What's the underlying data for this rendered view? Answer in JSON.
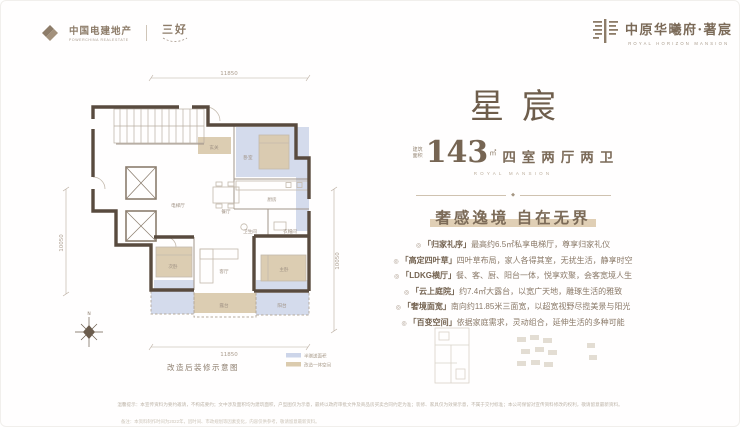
{
  "header": {
    "left": {
      "brand": "中国电建地产",
      "brand_en": "POWERCHINA REALESTATE",
      "sub_brand": "三好"
    },
    "right": {
      "brand": "中原华曦府·著宸",
      "brand_en": "ROYAL HORIZON MANSION"
    }
  },
  "panel": {
    "title": "星宸",
    "area_prefix_top": "建筑",
    "area_prefix_bottom": "面积",
    "area_value": "143",
    "area_unit": "㎡",
    "layout_text": "四室两厅两卫",
    "layout_en": "ROYAL MANSION",
    "divider_glyph": "◆",
    "slogan": "奢感逸境 自在无界",
    "bullet": "◎",
    "features": [
      {
        "tag": "「归家礼序」",
        "desc": "最高约6.5㎡私享电梯厅，尊享归家礼仪"
      },
      {
        "tag": "「高定四叶草」",
        "desc": "四叶草布局，家人各得其室，无扰生活，静享时空"
      },
      {
        "tag": "「LDKG横厅」",
        "desc": "餐、客、厨、阳台一体，悦享欢聚，会客宽境人生"
      },
      {
        "tag": "「云上庭院」",
        "desc": "约7.4㎡大露台，以宽广天地，雕琢生活的雅致"
      },
      {
        "tag": "「奢境面宽」",
        "desc": "南向约11.85米三面宽，以超宽视野尽揽美景与阳光"
      },
      {
        "tag": "「百变空间」",
        "desc": "依据家庭需求，灵动组合，延伸生活的多种可能"
      }
    ]
  },
  "floorplan": {
    "dims": {
      "top": "11850",
      "bottom": "11850",
      "left": "10050",
      "right": "10050"
    },
    "rooms": {
      "core": "电梯厅",
      "foyer": "玄关",
      "bed2": "卧室",
      "kitchen": "厨房",
      "bath": "卫生间",
      "cloak": "衣帽间",
      "dining": "餐厅",
      "living": "客厅",
      "bed3": "次卧",
      "master": "主卧",
      "terrace": "露台",
      "balcony": "阳台"
    },
    "caption": "改造后装修示意图",
    "legend": {
      "blue": "半赠送面积",
      "tan": "改造一体空间"
    },
    "compass": "N",
    "colors": {
      "wall": "#584a3e",
      "blue": "#cdd5e9",
      "tan": "#dbcbae"
    }
  },
  "footer": {
    "line1": "温馨提示：本宣传资料为要约邀请，不构成要约；文中涉及面积均为建筑面积，户型图仅为示意，最终以政府审批文件及商品房买卖合同约定为准；装修、家具仅为效果示意，不属于交付标准；本公司保留对宣传资料修改的权利，敬请留意最新资料。",
    "line2": "备注：本资料制作时间为2022年，因时间、市政规划等因素变化，内容仅供参考，敬请留意最新资料。"
  }
}
